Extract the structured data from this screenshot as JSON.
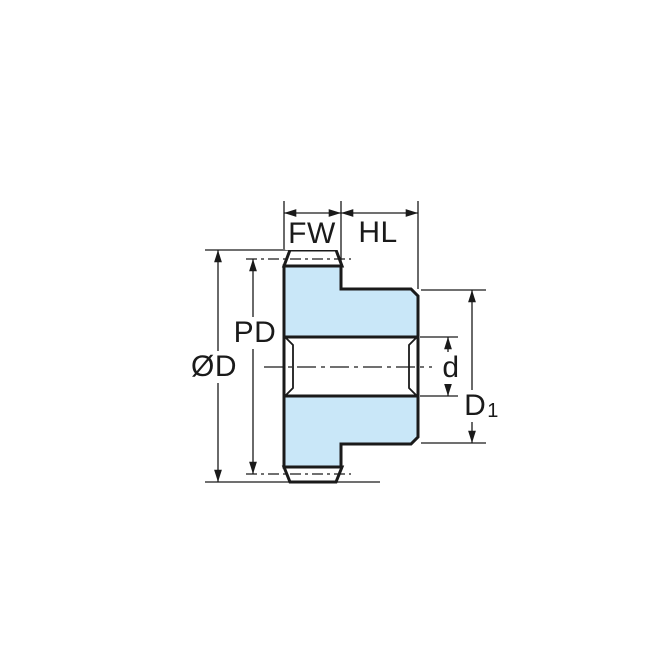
{
  "diagram": {
    "labels": {
      "face_width": "FW",
      "hub_length": "HL",
      "pitch_diameter": "PD",
      "outside_diameter": "ØD",
      "bore_diameter": "d",
      "hub_diameter_main": "D",
      "hub_diameter_sub": "1"
    },
    "colors": {
      "gear_fill": "#C9E7F8",
      "line": "#1A1A1A",
      "background": "#FFFFFF"
    }
  }
}
